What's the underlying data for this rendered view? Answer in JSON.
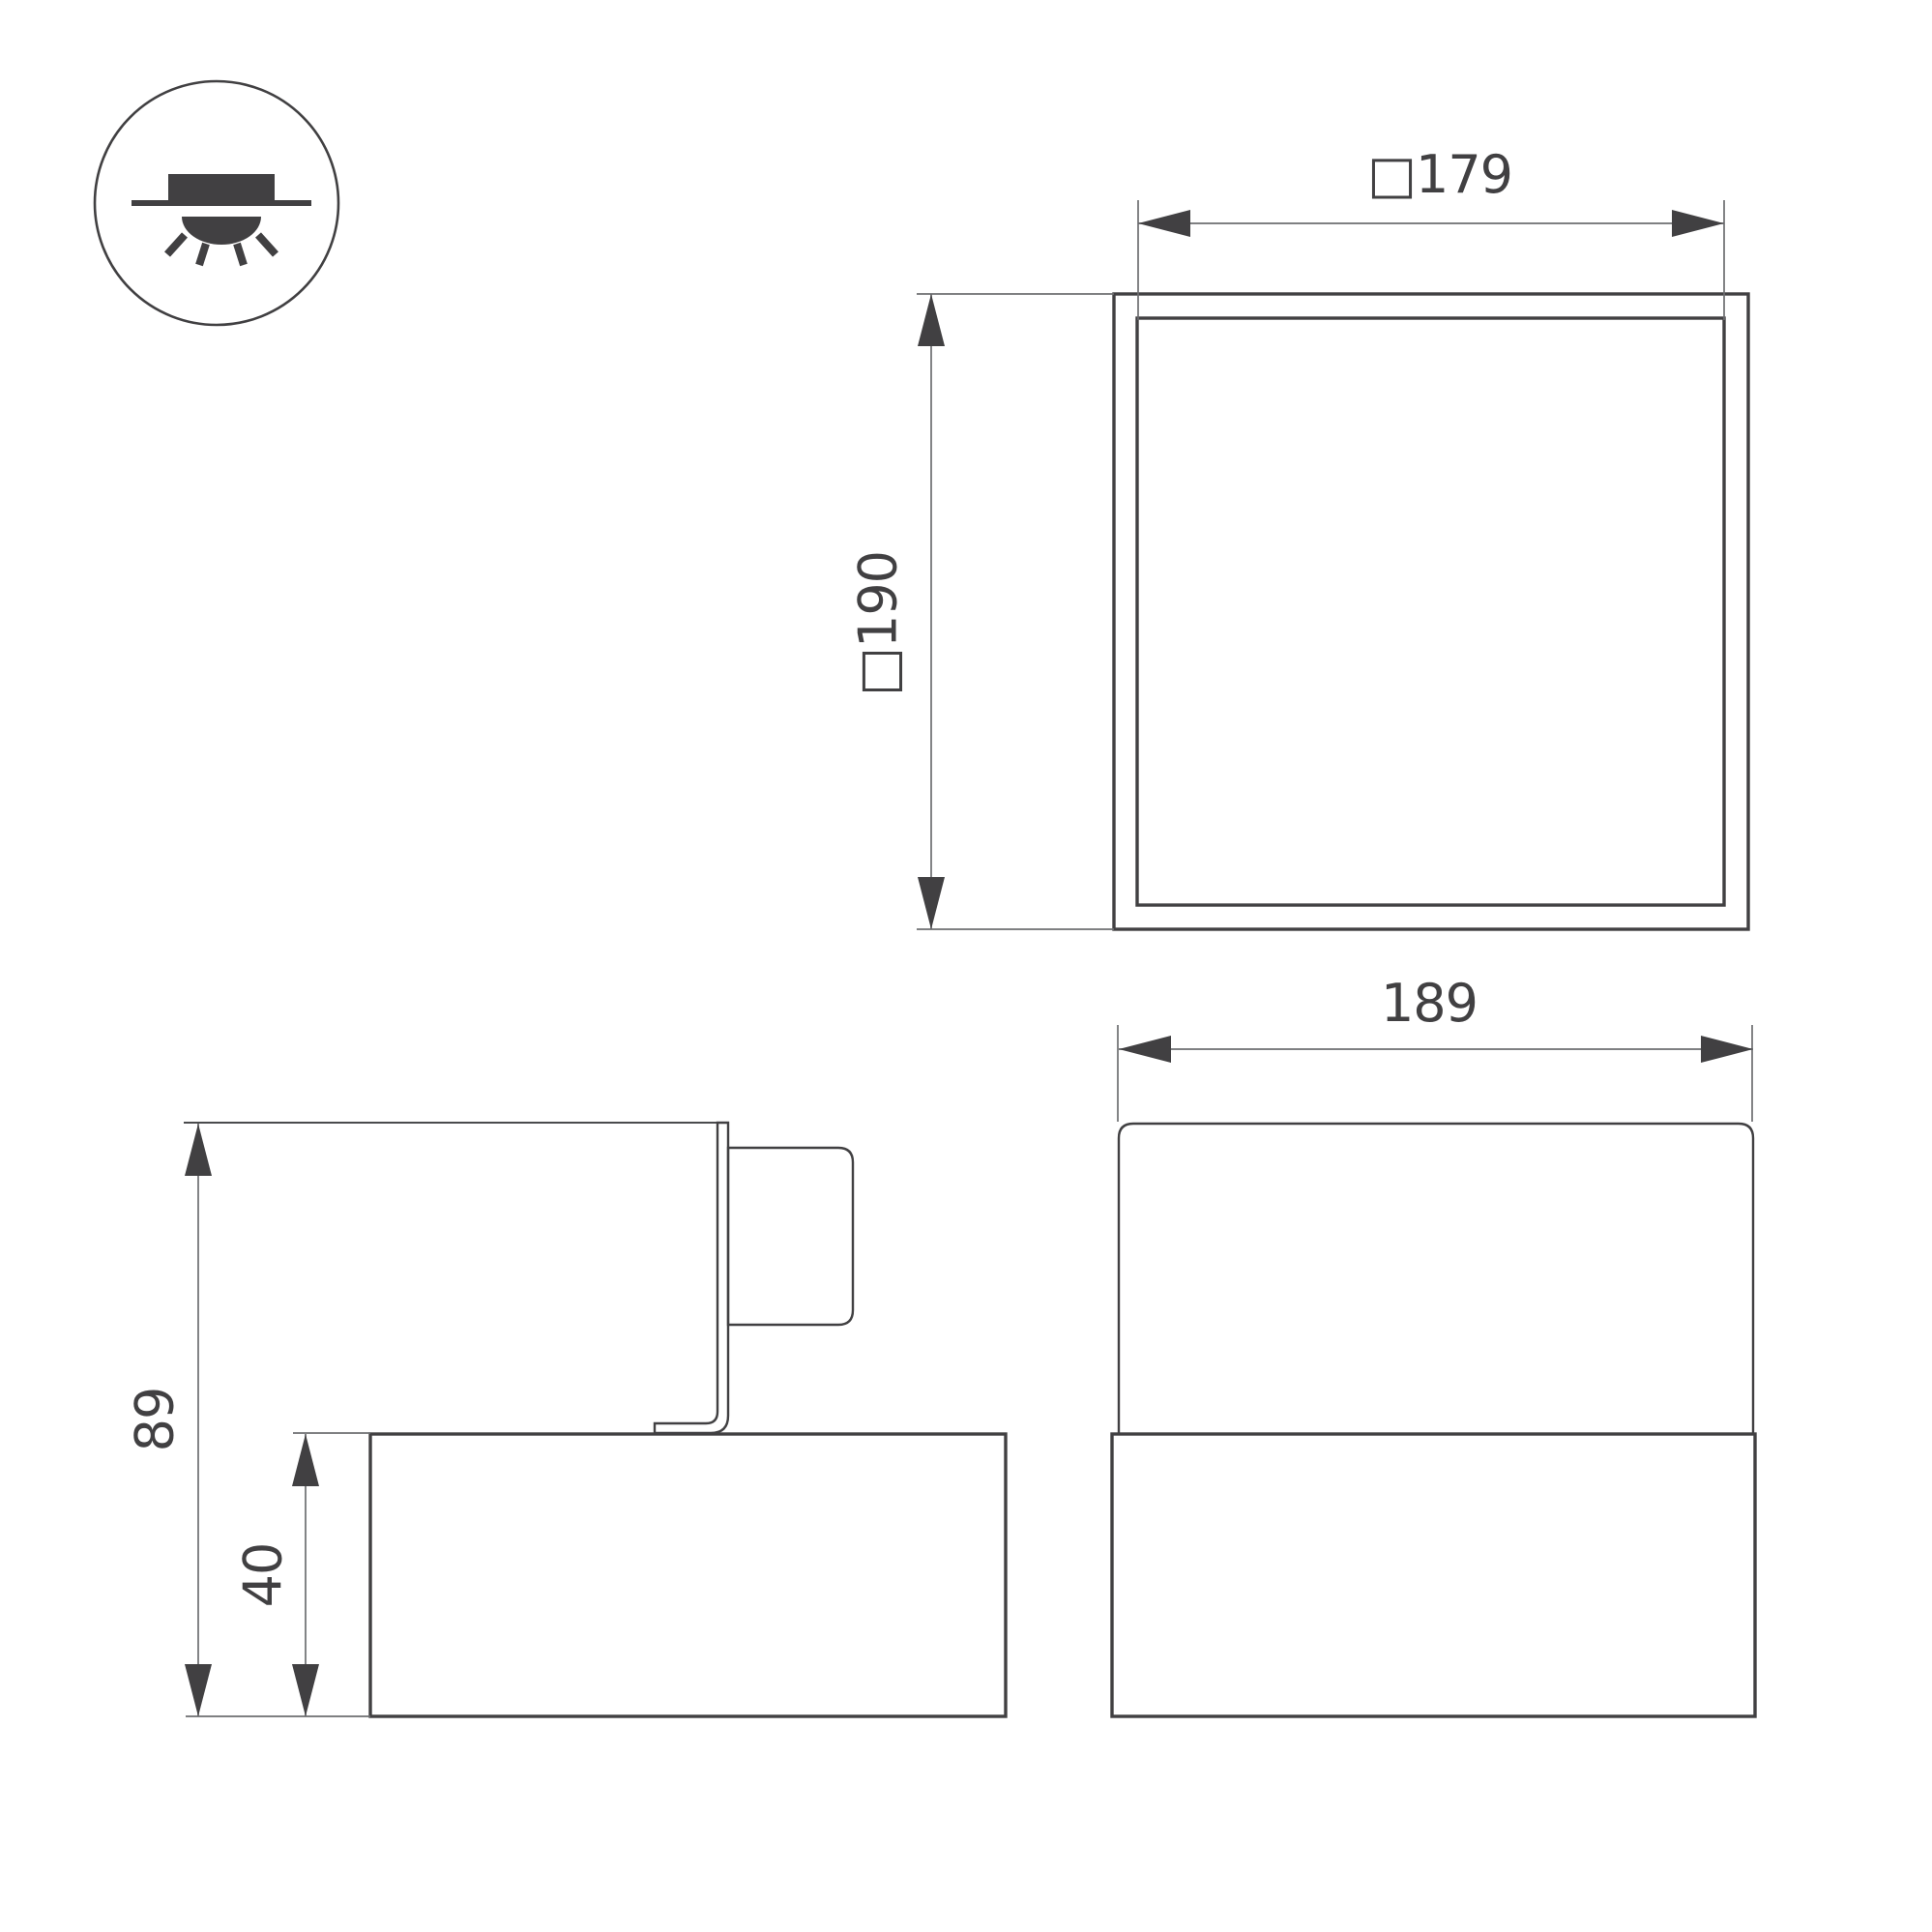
{
  "colors": {
    "ink": "#414042",
    "faint": "#6d6e71",
    "edge": "#4a4b4d",
    "bg": "#ffffff"
  },
  "icon": {
    "type": "recessed-ceiling-light-symbol"
  },
  "views": {
    "plan": {
      "width_label": "□179",
      "height_label": "□190"
    },
    "side": {
      "total_height_label": "89",
      "base_height_label": "40"
    },
    "front": {
      "width_label": "189"
    }
  }
}
